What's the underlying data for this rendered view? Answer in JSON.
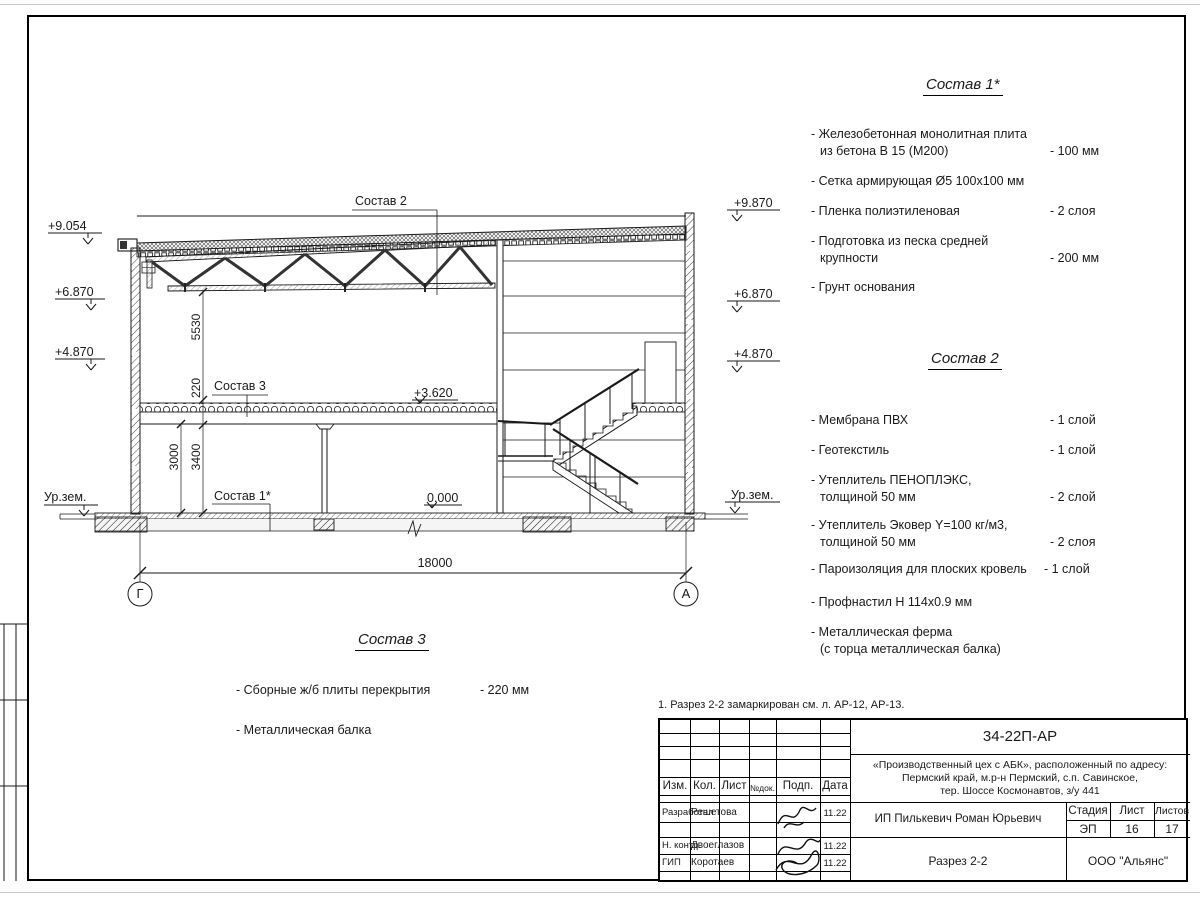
{
  "section": {
    "elev_left": [
      "+9.054",
      "+6.870",
      "+4.870",
      "Ур.зем."
    ],
    "elev_right": [
      "+9.870",
      "+6.870",
      "+4.870",
      "Ур.зем."
    ],
    "elev_floor2": "+3.620",
    "elev_floor1": "0.000",
    "dims": {
      "truss_clear": "5530",
      "slab_pack": "220",
      "clear1": "3000",
      "floor1": "3400",
      "span": "18000"
    },
    "leaders": {
      "roof": "Состав 2",
      "slab": "Состав 3",
      "floor": "Состав 1*"
    },
    "grid": [
      "Г",
      "А"
    ]
  },
  "lists": {
    "sostav1": {
      "title": "Состав 1*",
      "items": [
        {
          "label": "- Железобетонная  монолитная плита\nиз бетона В 15 (М200)",
          "value": "- 100 мм"
        },
        {
          "label": "- Сетка армирующая Ø5 100x100 мм",
          "value": ""
        },
        {
          "label": "- Пленка полиэтиленовая",
          "value": "-  2 слоя"
        },
        {
          "label": "- Подготовка из песка средней\nкрупности",
          "value": "- 200 мм"
        },
        {
          "label": "- Грунт основания",
          "value": ""
        }
      ]
    },
    "sostav2": {
      "title": "Состав 2",
      "items": [
        {
          "label": "- Мембрана ПВХ",
          "value": "- 1 слой"
        },
        {
          "label": "- Геотекстиль",
          "value": "- 1 слой"
        },
        {
          "label": "- Утеплитель ПЕНОПЛЭКС,\nтолщиной 50 мм",
          "value": "- 2 слой"
        },
        {
          "label": "- Утеплитель Эковер Y=100 кг/м3,\nтолщиной 50 мм",
          "value": "- 2 слоя"
        },
        {
          "label": "- Пароизоляция для плоских кровель",
          "value": "- 1 слой"
        },
        {
          "label": "- Профнастил Н 114x0.9 мм",
          "value": ""
        },
        {
          "label": "- Металлическая ферма\n(с торца металлическая балка)",
          "value": ""
        }
      ]
    },
    "sostav3": {
      "title": "Состав 3",
      "items": [
        {
          "label": "- Сборные ж/б  плиты перекрытия",
          "value": "- 220 мм"
        },
        {
          "label": "- Металлическая балка",
          "value": ""
        }
      ]
    }
  },
  "note": "1. Разрез 2-2 замаркирован см. л. АР-12, АР-13.",
  "titleblock": {
    "doc_code": "34-22П-АР",
    "project": "«Производственный цех с АБК», расположенный по адресу:\nПермский край, м.р-н Пермский, с.п. Савинское,\nтер. Шоссе Космонавтов, з/у 441",
    "headers": [
      "Изм.",
      "Кол.",
      "Лист",
      "№док.",
      "Подп.",
      "Дата"
    ],
    "rows": [
      {
        "role": "Разработал",
        "name": "Решетова",
        "date": "11.22"
      },
      {
        "role": "Н. контр.",
        "name": "Двоеглазов",
        "date": "11.22"
      },
      {
        "role": "ГИП",
        "name": "Коротаев",
        "date": "11.22"
      }
    ],
    "client": "ИП Пилькевич Роман Юрьевич",
    "stage_label": "Стадия",
    "sheet_label": "Лист",
    "sheets_label": "Листов",
    "stage": "ЭП",
    "sheet": "16",
    "sheets": "17",
    "drawing_title": "Разрез 2-2",
    "company": "ООО \"Альянс\""
  }
}
